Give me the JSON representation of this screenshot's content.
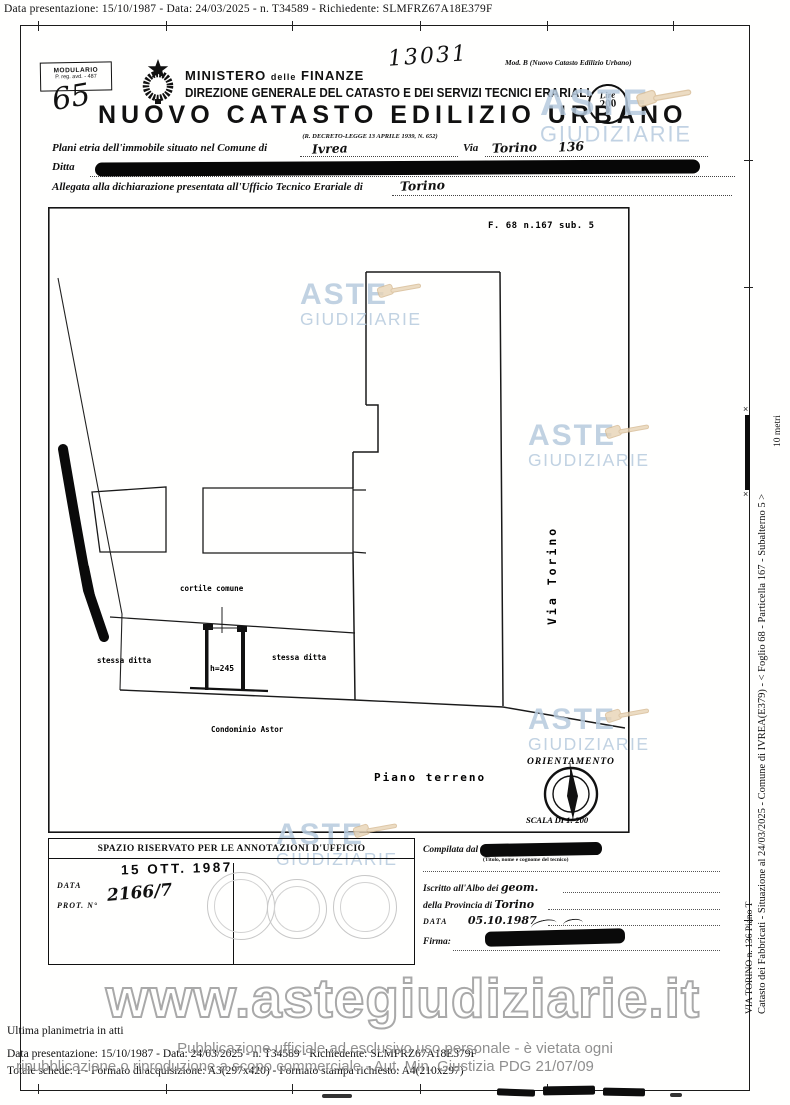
{
  "meta_top": "Data presentazione: 15/10/1987 - Data: 24/03/2025 - n. T34589 - Richiedente: SLMFRZ67A18E379F",
  "header": {
    "modulario_line1": "MODULARIO",
    "modulario_line2": "P. reg. avd. - 487",
    "handwritten_sheet": "65",
    "handwritten_number": "13031",
    "mod_b": "Mod. B (Nuovo Catasto Edilizio Urbano)",
    "ministry_1": "MINISTERO",
    "ministry_2": "delle",
    "ministry_3": "FINANZE",
    "direzione": "DIREZIONE GENERALE DEL CATASTO E DEI SERVIZI TECNICI ERARIALI",
    "title": "NUOVO CATASTO EDILIZIO URBANO",
    "subtitle": "(R. DECRETO-LEGGE 13 APRILE 1939, N. 652)",
    "lire_label": "Lire",
    "lire_value": "200"
  },
  "form": {
    "line1_label": "Plani etria dell'immobile situato nel Comune di",
    "comune_value": "Ivrea",
    "via_label": "Via",
    "via_value": "Torino",
    "civico_value": "136",
    "ditta_label": "Ditta",
    "line3_label": "Allegata alla dichiarazione presentata all'Ufficio Tecnico Erariale di",
    "ufficio_value": "Torino"
  },
  "plan": {
    "ref": "F. 68 n.167 sub. 5",
    "labels": {
      "cortile": "cortile comune",
      "stessa_left": "stessa ditta",
      "h_value": "h=245",
      "stessa_right": "stessa ditta",
      "condominio": "Condominio Astor",
      "via_street": "Via Torino",
      "piano": "Piano terreno",
      "orientamento": "ORIENTAMENTO",
      "scala": "SCALA DI 1: 200"
    }
  },
  "margin": {
    "scale_label": "10 metri",
    "caption_via": "VIA TORINO n. 136 Piano T",
    "caption_catasto": "Catasto dei Fabbricati - Situazione al 24/03/2025 - Comune di IVREA(E379) - < Foglio 68 - Particella 167 - Subalterno 5 >"
  },
  "annotations": {
    "header": "SPAZIO RISERVATO PER LE ANNOTAZIONI D'UFFICIO",
    "date_stamp": "15 OTT. 1987",
    "data_label": "DATA",
    "prot_label": "PROT. N°",
    "prot_value": "2166/7"
  },
  "compiled": {
    "compilata_label": "Compilata dal",
    "tecnico_hint": "(Titolo, nome e cognome del tecnico)",
    "iscritto_label": "Iscritto all'Albo dei",
    "iscritto_value": "geom.",
    "provincia_label": "della Provincia di",
    "provincia_value": "Torino",
    "data_label": "DATA",
    "data_value": "05.10.1987",
    "firma_label": "Firma:"
  },
  "footer": {
    "ultima": "Ultima planimetria in atti",
    "presentazione": "Data presentazione: 15/10/1987 - Data: 24/03/2025 - n. T34589 - Richiedente: SLMFRZ67A18E379F",
    "totale": "Totale schede: 1 - Formato di acquisizione: A3(297x420) - Formato stampa richiesto: A4(210x297)",
    "disclaimer1": "Pubblicazione ufficiale ad esclusivo uso personale - è vietata ogni",
    "disclaimer2": "ripubblicazione o riproduzione a scopo commerciale - Aut. Min. Giustizia PDG 21/07/09"
  },
  "watermark": {
    "line1": "ASTE",
    "line2": "GIUDIZIARIE",
    "url": "www.astegiudiziarie.it"
  },
  "colors": {
    "watermark_blue": "#b7cbde",
    "gavel_tan": "#e8d4b5",
    "disclaimer_gray": "#8f8f8f",
    "ink_black": "#111111"
  }
}
